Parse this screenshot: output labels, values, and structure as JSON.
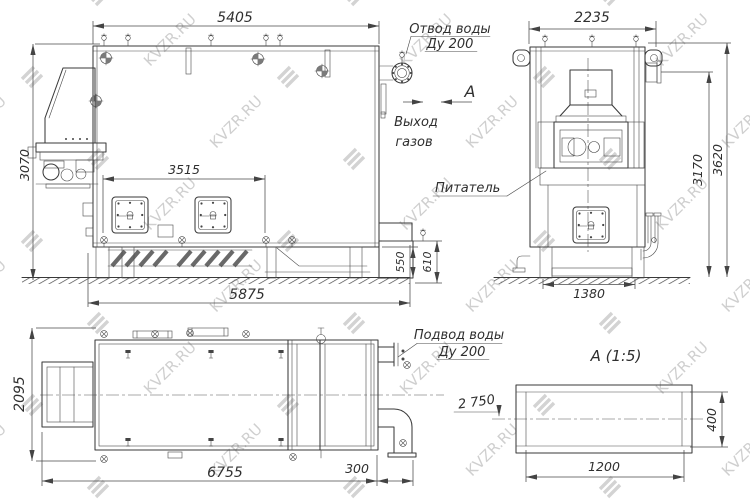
{
  "watermark": {
    "text": "KVZR.RU"
  },
  "callouts": {
    "water_outlet_line1": "Отвод воды",
    "water_outlet_line2": "Ду 200",
    "gas_exit_line1": "Выход",
    "gas_exit_line2": "газов",
    "section_mark": "А",
    "feeder_label": "Питатель",
    "water_inlet_line1": "Подвод воды",
    "water_inlet_line2": "Ду 200",
    "distance_note": "2 750",
    "section_view_title": "А  (1:5)"
  },
  "dimensions": {
    "front": {
      "width_top": "5405",
      "height_left": "3070",
      "doors_span": "3515",
      "base_length": "5875",
      "base_height": "550",
      "outlet_height": "610"
    },
    "side": {
      "width_top": "2235",
      "height_to_outlet": "3170",
      "height_total": "3620",
      "base_width": "1380"
    },
    "plan": {
      "depth": "2095",
      "length": "6755",
      "pipe_extension": "300"
    },
    "section": {
      "width": "1200",
      "height": "400"
    }
  },
  "style": {
    "line_color": "#3a3a3a",
    "watermark_color": "#a9a9a9",
    "background": "#ffffff"
  }
}
